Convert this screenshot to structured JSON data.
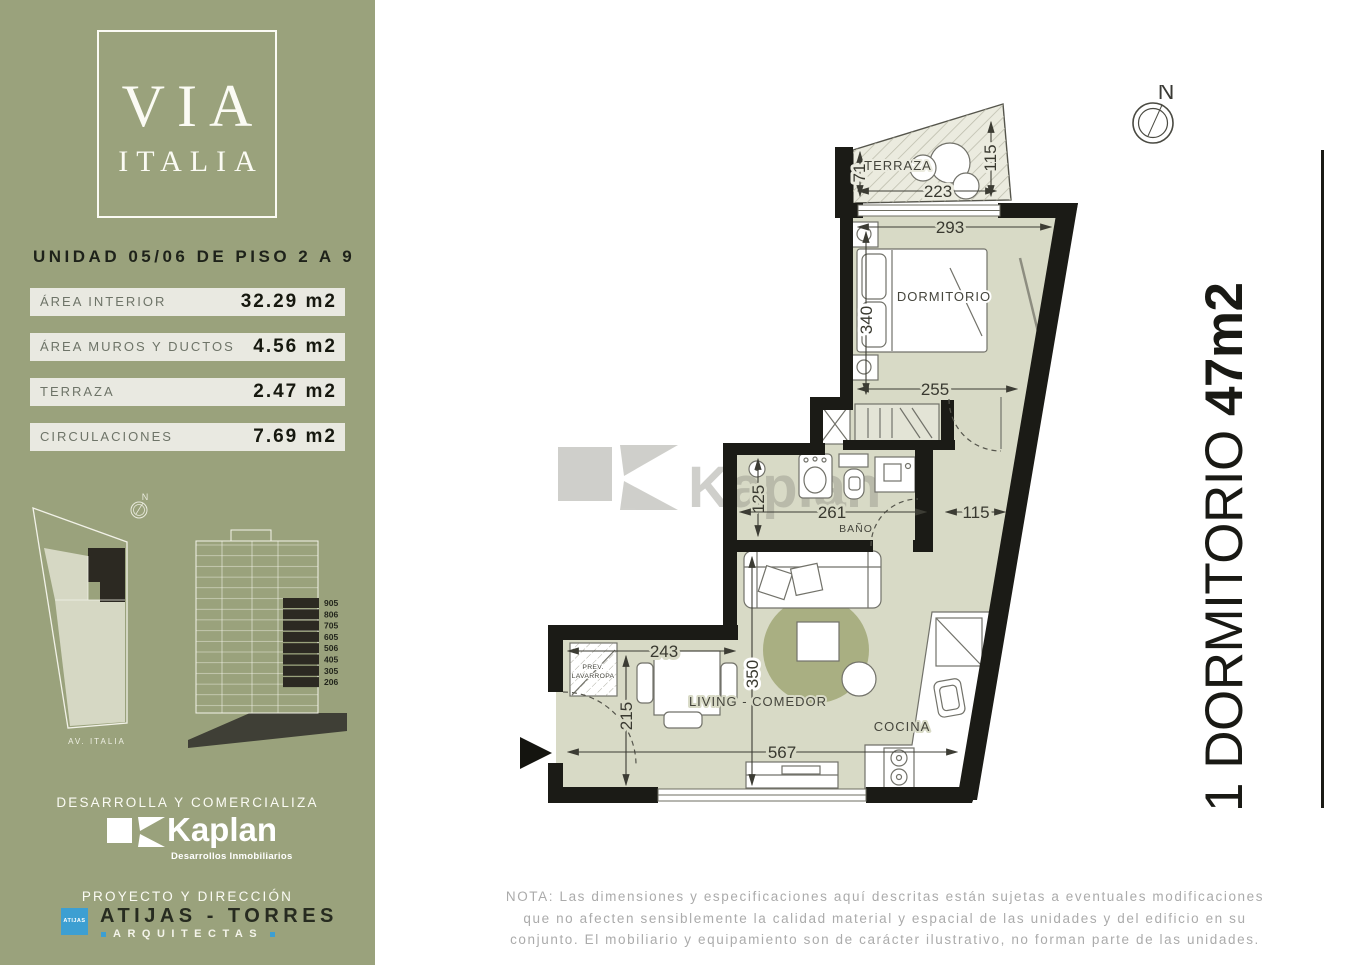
{
  "brand": {
    "logo_line1": "VIA",
    "logo_line2": "ITALIA"
  },
  "sidebar": {
    "unit_title": "UNIDAD 05/06 DE PISO 2 A 9",
    "areas": [
      {
        "label": "ÁREA INTERIOR",
        "value": "32.29 m2"
      },
      {
        "label": "ÁREA MUROS Y DUCTOS",
        "value": "4.56 m2"
      },
      {
        "label": "TERRAZA",
        "value": "2.47 m2"
      },
      {
        "label": "CIRCULACIONES",
        "value": "7.69 m2"
      }
    ],
    "site": {
      "north": "N",
      "street": "AV. ITALIA"
    },
    "section_floors": [
      "905",
      "806",
      "705",
      "605",
      "506",
      "405",
      "305",
      "206"
    ],
    "developer": {
      "heading": "DESARROLLA Y COMERCIALIZA",
      "brand": "Kaplan",
      "tagline": "Desarrollos Inmobiliarios"
    },
    "architects": {
      "heading": "PROYECTO Y DIRECCIÓN",
      "badge": "ATIJAS",
      "name": "ATIJAS - TORRES",
      "subtitle": "ARQUITECTAS"
    }
  },
  "plan": {
    "north": "N",
    "watermark": "Kaplan",
    "labels": {
      "terraza": "TERRAZA",
      "dormitorio": "DORMITORIO",
      "bano": "BAÑO",
      "living": "LIVING - COMEDOR",
      "cocina": "COCINA",
      "prev1": "PREV.",
      "prev2": "LAVARROPA"
    },
    "dims": {
      "terraza_depth": "71",
      "terraza_width": "223",
      "terraza_side": "115",
      "dorm_width": "293",
      "dorm_depth": "340",
      "dorm_inner": "255",
      "bath_depth": "125",
      "bath_width": "261",
      "hall_width": "115",
      "dining": "243",
      "living_depth": "350",
      "entry_depth": "215",
      "living_width": "567"
    }
  },
  "side_title": {
    "label": "1 DORMITORIO ",
    "area": "47m2"
  },
  "note": {
    "line1": "NOTA: Las dimensiones y especificaciones aquí descritas están sujetas a eventuales modificaciones",
    "line2": "que no afecten sensiblemente la calidad material y espacial de las unidades y del edificio en su",
    "line3": "conjunto. El mobiliario y equipamiento son de carácter ilustrativo, no forman parte de las unidades."
  }
}
